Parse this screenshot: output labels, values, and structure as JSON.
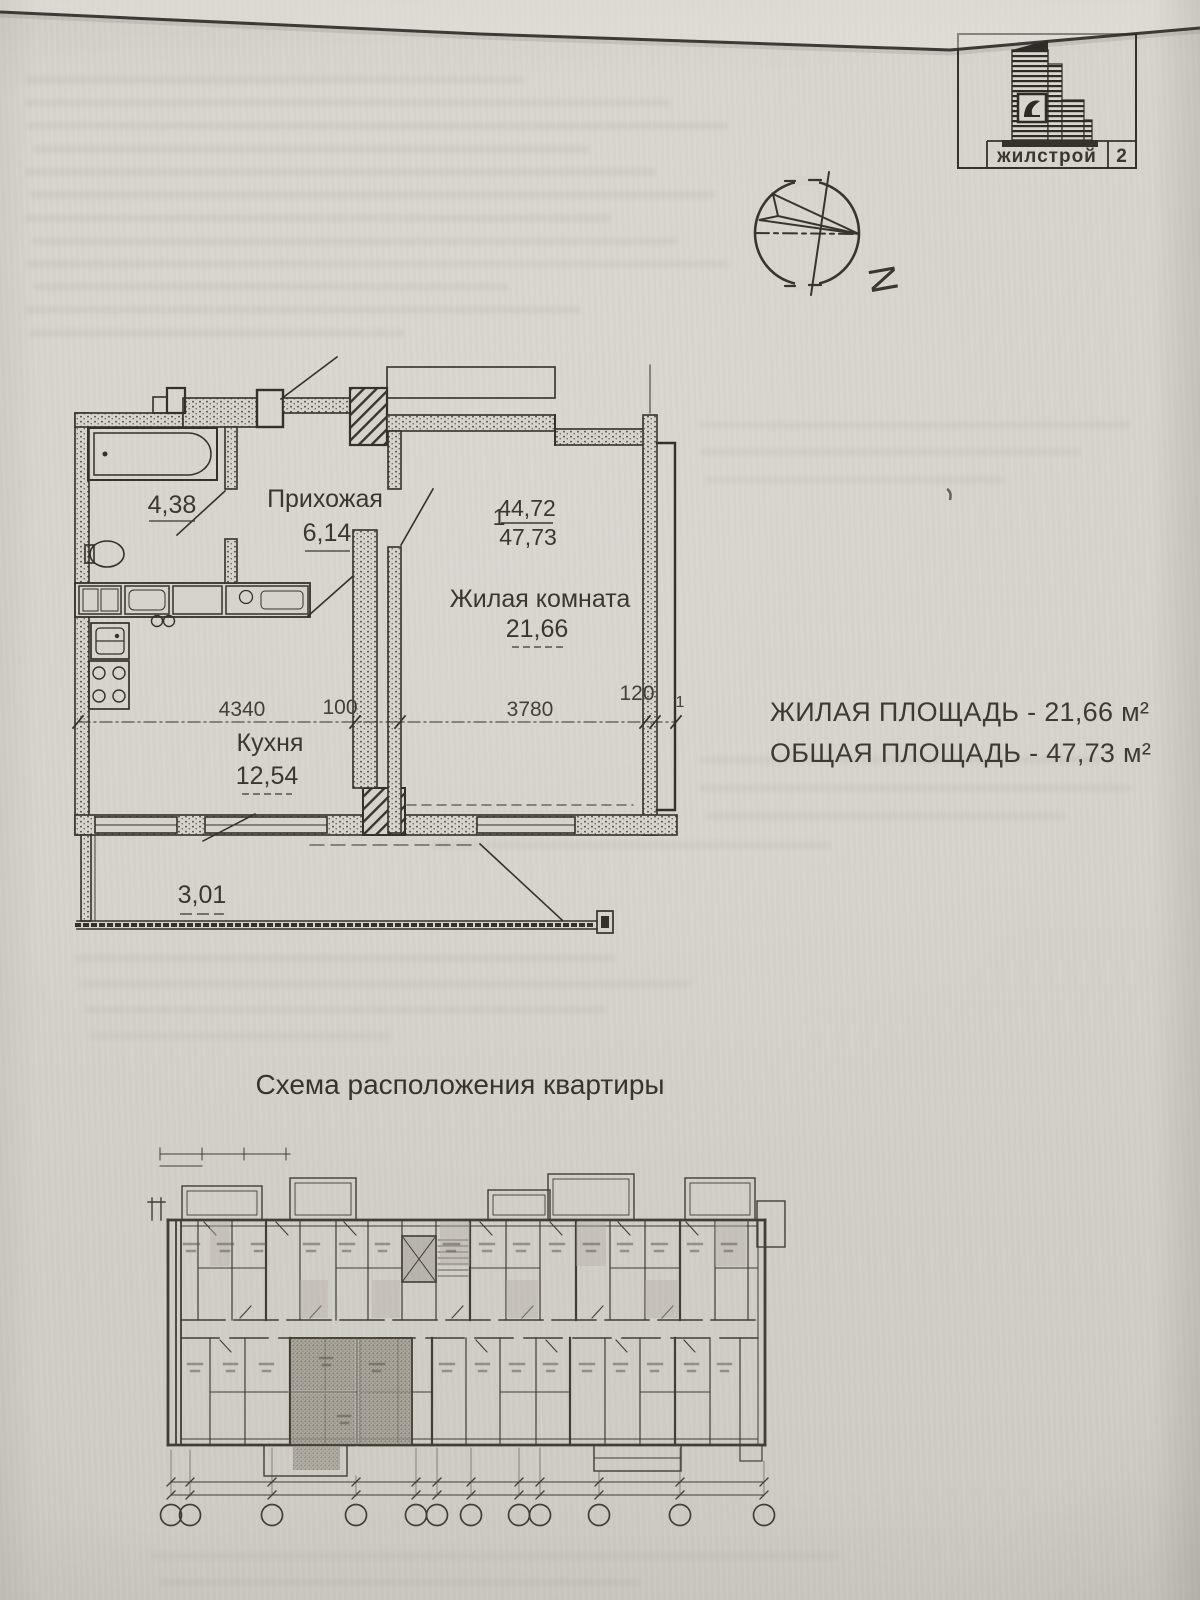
{
  "logo": {
    "company": "жилстрой",
    "block_number": "2"
  },
  "compass": {
    "north_label": "N"
  },
  "floor_plan": {
    "apartment_number": "1",
    "living_area_value": "44,72",
    "total_area_value": "47,73",
    "bathroom_area": "4,38",
    "hallway_label": "Прихожая",
    "hallway_area": "6,14",
    "living_room_label": "Жилая комната",
    "living_room_area": "21,66",
    "kitchen_label": "Кухня",
    "kitchen_area": "12,54",
    "balcony_area": "3,01",
    "dimensions": {
      "kitchen_width_mm": "4340",
      "partition_mm": "100",
      "living_width_mm": "3780",
      "wall_mm": "120",
      "axis_mark": "1"
    }
  },
  "summary": {
    "living_area_line": "ЖИЛАЯ ПЛОЩАДЬ - 21,66 м²",
    "total_area_line": "ОБЩАЯ ПЛОЩАДЬ - 47,73 м²"
  },
  "location_scheme": {
    "title": "Схема расположения квартиры"
  }
}
